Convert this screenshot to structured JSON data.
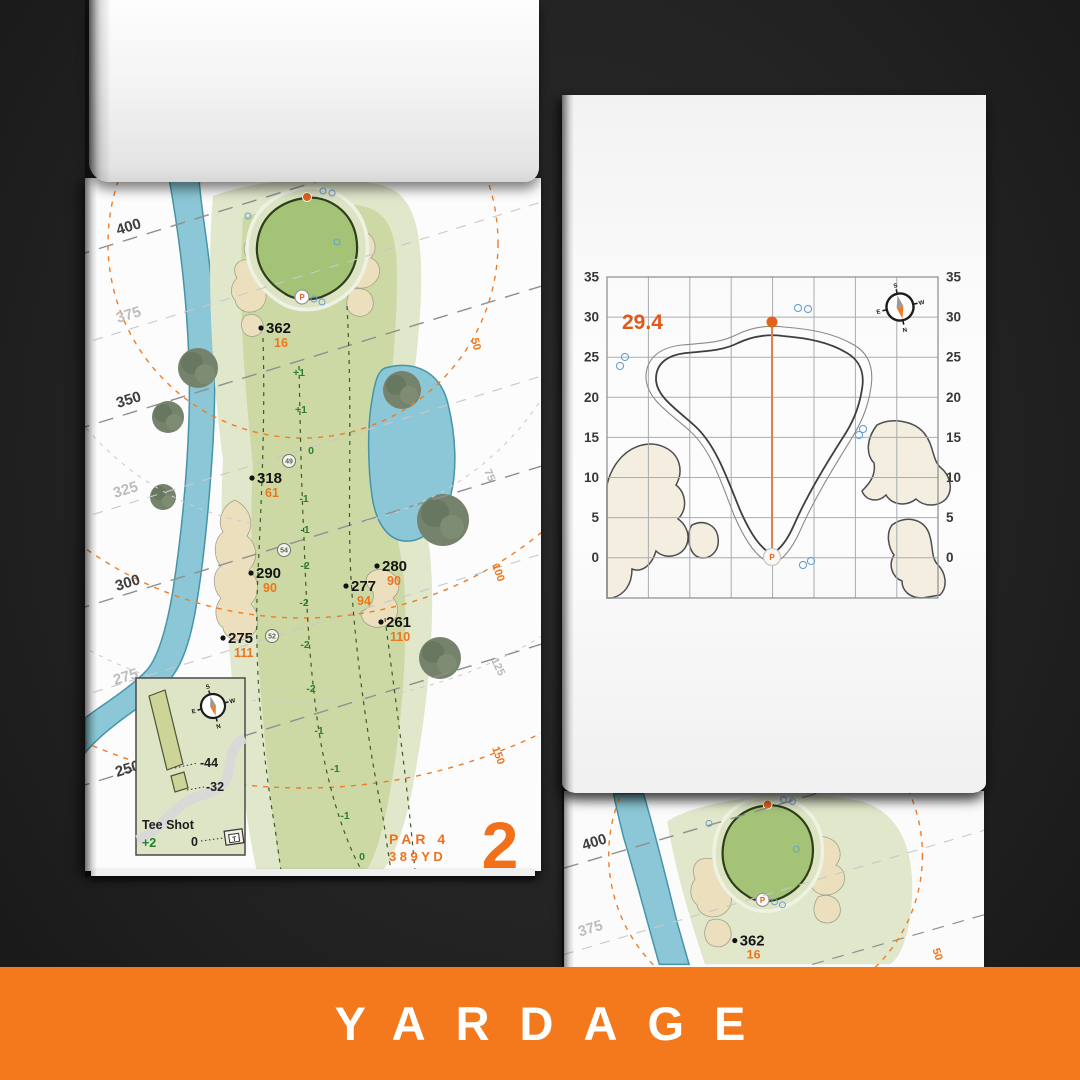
{
  "banner": {
    "label": "YARDAGE",
    "color": "#f4781c"
  },
  "hole_page": {
    "hole_number": "2",
    "par_label": "PAR 4",
    "yards_label": "389YD",
    "pin_mark": "P",
    "distance_labels": [
      "400",
      "375",
      "350",
      "325",
      "300",
      "275",
      "250"
    ],
    "radius_labels": {
      "r50": "50",
      "r75": "75",
      "r100": "100",
      "r125": "125",
      "r150": "150"
    },
    "markers": [
      {
        "carry": "362",
        "rem": "16"
      },
      {
        "carry": "318",
        "rem": "61"
      },
      {
        "carry": "290",
        "rem": "90"
      },
      {
        "carry": "275",
        "rem": "111"
      },
      {
        "carry": "277",
        "rem": "94"
      },
      {
        "carry": "280",
        "rem": "90"
      },
      {
        "carry": "261",
        "rem": "110"
      }
    ],
    "centerline": [
      "+1",
      "+1",
      "0",
      "-1",
      "-1",
      "-2",
      "-2",
      "-2",
      "-2",
      "-1",
      "-1",
      "-1",
      "0"
    ],
    "circled": [
      "49",
      "54",
      "52"
    ],
    "tee_inset": {
      "title": "Tee Shot",
      "elevation": "+2",
      "zero": "0",
      "offset_long": "-44",
      "offset_short": "-32",
      "tee_mark": "T"
    },
    "compass": {
      "n": "N",
      "s": "S",
      "e": "E",
      "w": "W"
    }
  },
  "green_page": {
    "depth_value": "29.4",
    "pin_mark": "P",
    "ticks": [
      "35",
      "30",
      "25",
      "20",
      "15",
      "10",
      "5",
      "0"
    ],
    "axis_min": 0,
    "axis_max": 35,
    "axis_step": 5,
    "compass": {
      "n": "N",
      "s": "S",
      "e": "E",
      "w": "W"
    }
  },
  "next_page": {
    "distance_labels": [
      "400",
      "375"
    ],
    "marker": {
      "carry": "362",
      "rem": "16"
    },
    "radius_label": "50"
  }
}
